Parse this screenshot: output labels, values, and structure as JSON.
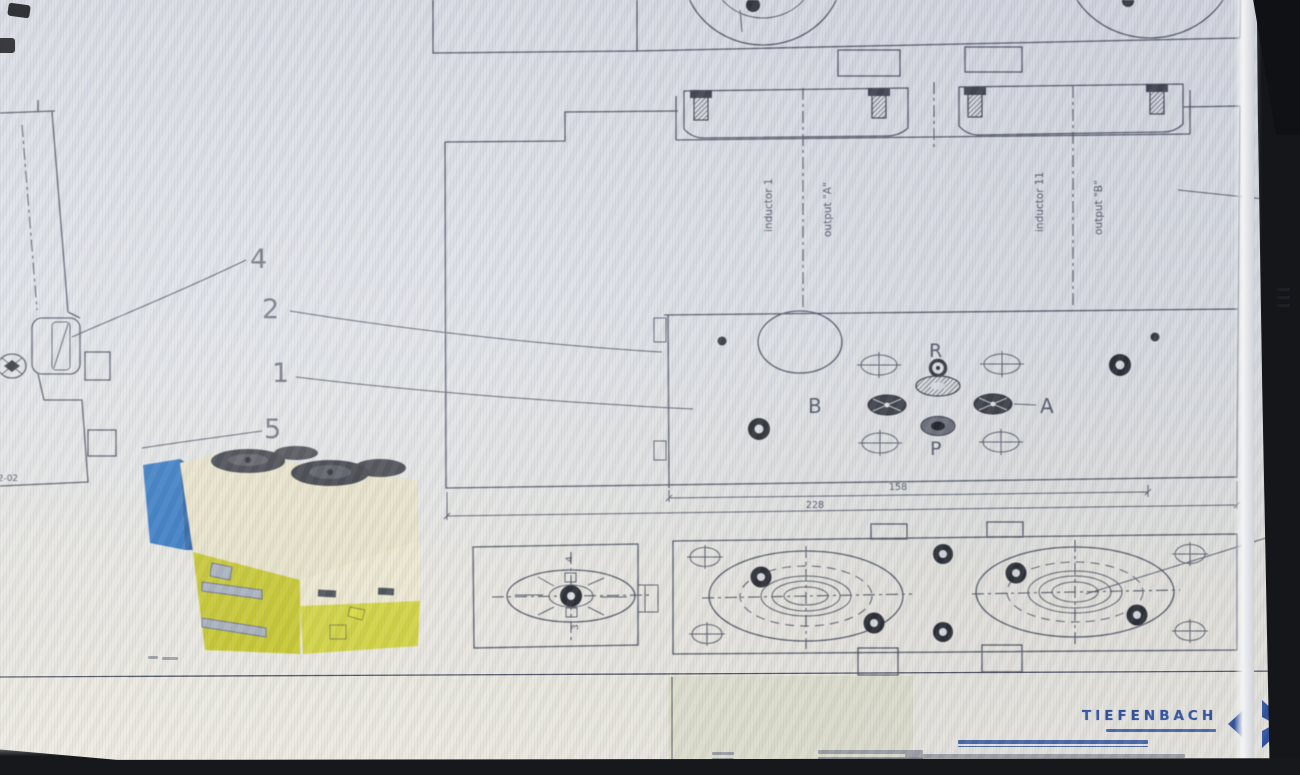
{
  "drawing": {
    "callouts": {
      "c4": "4",
      "c2": "2",
      "c1": "1",
      "c5": "5"
    },
    "ports": {
      "r": "R",
      "b": "B",
      "a": "A",
      "p": "P"
    },
    "stations": {
      "s1_inductor": "inductor 1",
      "s1_output": "output \"A\"",
      "s2_inductor": "inductor 11",
      "s2_output": "output \"B\""
    },
    "dims": {
      "inner": "158",
      "outer": "228"
    },
    "side_note": "12-02",
    "flange_labels": {
      "top": "4",
      "bottom": "3"
    }
  },
  "title_block": {
    "brand": "TIEFENBACH"
  },
  "colors": {
    "line": "#4e5463",
    "brand_blue": "#2b4fa0",
    "valve_yellow": "#c6c730",
    "valve_cream": "#e7e2c9",
    "valve_blue": "#3579c2"
  }
}
